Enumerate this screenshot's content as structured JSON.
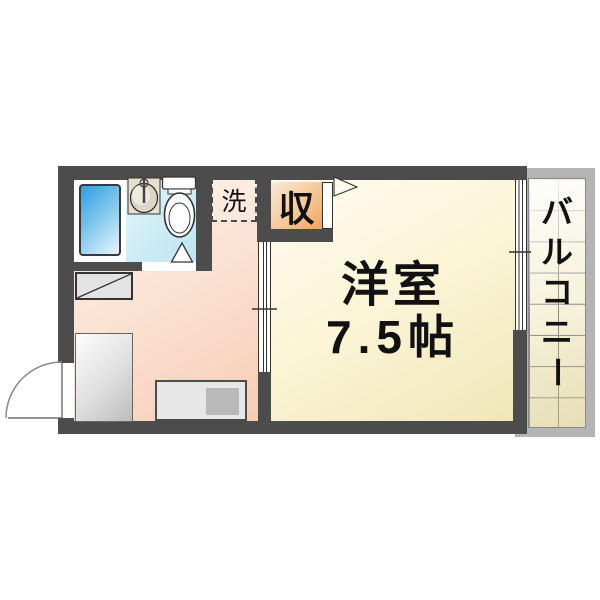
{
  "labels": {
    "main_room_line1": "洋室",
    "main_room_line2": "7.5帖",
    "closet": "収",
    "laundry": "洗",
    "balcony": "バルコニー"
  },
  "colors": {
    "wall": "#4C4C4C",
    "main_room_floor": "#FBF4D6",
    "kitchen_floor": "#FBE3D4",
    "bathroom_floor": "#CFEDF6",
    "bathtub_blue": "#2E9EE2",
    "closet_orange": "#EDA55F",
    "balcony_tile": "#F6F1D9",
    "balcony_frame": "#B4B4B4",
    "counter_gray": "#E7E7E7"
  }
}
